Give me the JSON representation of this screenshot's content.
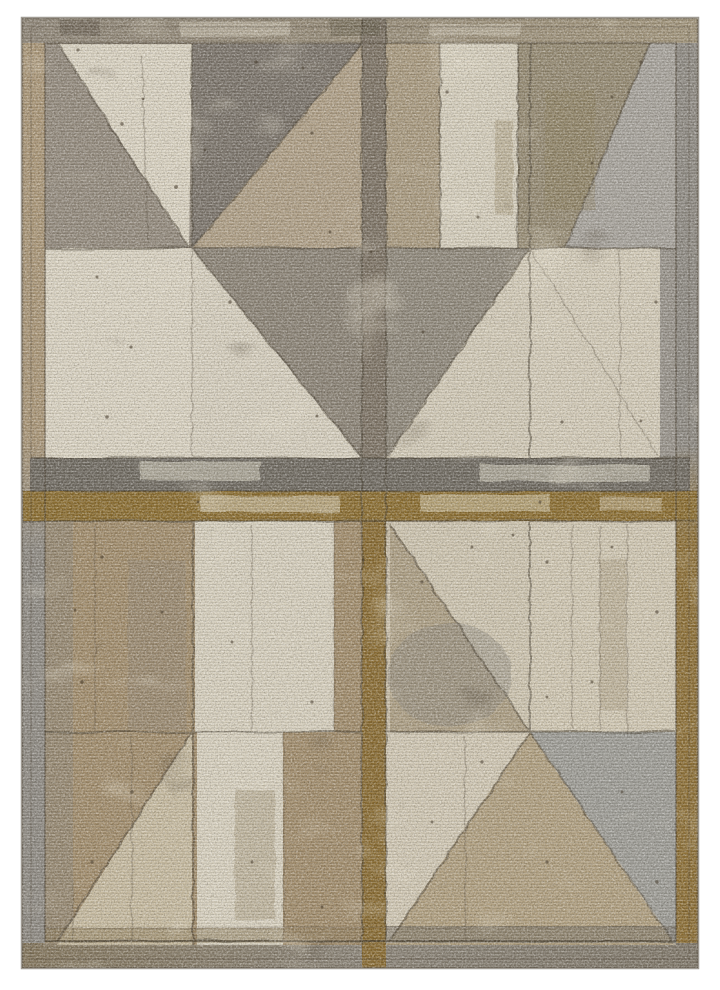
{
  "image": {
    "type": "product-photo",
    "subject": "Distressed geometric patchwork area rug with pinwheel barn-door panel design in gray, taupe, tan, cream and olive tones",
    "background": "#ffffff"
  },
  "colors": {
    "page_bg": "#ffffff",
    "outline": "#5f564a",
    "seam": "#4a3f30",
    "dot": "#44392a",
    "border_tan": "#ab9778",
    "border_gray": "#8f8b84",
    "border_olive": "#8d6f35",
    "border_top_a": "#8f8678",
    "border_top_b": "#a3967c",
    "border_bot_a": "#84765c",
    "border_bot_b": "#8b8478",
    "border_bot_c": "#7f7769",
    "vrail_top": "#7d7365",
    "vrail_bot": "#896b31",
    "rail_gray": "#6f6a61",
    "rail_olive": "#8b6d2f",
    "tl_base": "#948b7e",
    "tl_cream": "#dcd5c4",
    "tl_dark": "#7b746b",
    "tl_tan": "#b0a087",
    "tl_cream2": "#d8d1c0",
    "tl_gray_se": "#8b8376",
    "tr_base": "#a1967f",
    "tr_tan_strip": "#aa9b80",
    "tr_cream": "#d7d0be",
    "tr_dark": "#958a72",
    "tr_silver": "#a8a49d",
    "tr_gray_sw": "#8f887b",
    "tr_cream_sw": "#d3cbb8",
    "tr_cream_se": "#d5cdba",
    "tr_gray_edge": "#99948c",
    "bl_base": "#a28d6c",
    "bl_gray": "#8a847b",
    "bl_cream_up": "#d8d1bf",
    "bl_light": "#c8bca1",
    "bl_cream_low": "#d9d2c0",
    "bl_dark_strip": "#8a7856",
    "br_base": "#c9bea8",
    "br_light_ne": "#cfc6b1",
    "br_sw": "#ad9f84",
    "br_gray_stain": "#8c887f",
    "br_cream_ne": "#d2c9b4",
    "br_west": "#d2c9b5",
    "br_south": "#b1a080",
    "br_east": "#9e9d97",
    "br_dark_strip": "#6f695f",
    "stain_cream": "#e6dfcd",
    "stain_brown": "#8a7a52",
    "stain_dark": "#564c3c",
    "grain_light": "#ffffff",
    "grain_dark": "#262017"
  },
  "rug": {
    "nail_holes": [
      [
        78,
        50,
        1.6
      ],
      [
        256,
        62,
        1.8
      ],
      [
        303,
        68,
        1.5
      ],
      [
        122,
        124,
        1.7
      ],
      [
        143,
        99,
        1.4
      ],
      [
        176,
        187,
        1.9
      ],
      [
        312,
        133,
        1.6
      ],
      [
        330,
        232,
        1.5
      ],
      [
        97,
        277,
        1.5
      ],
      [
        230,
        302,
        1.7
      ],
      [
        131,
        347,
        1.6
      ],
      [
        107,
        417,
        1.8
      ],
      [
        317,
        416,
        1.5
      ],
      [
        371,
        252,
        1.5
      ],
      [
        363,
        560,
        1.5
      ],
      [
        447,
        92,
        1.6
      ],
      [
        478,
        217,
        1.5
      ],
      [
        612,
        97,
        1.5
      ],
      [
        641,
        62,
        1.7
      ],
      [
        592,
        163,
        1.4
      ],
      [
        656,
        302,
        1.6
      ],
      [
        423,
        332,
        1.5
      ],
      [
        562,
        422,
        1.6
      ],
      [
        641,
        421,
        1.4
      ],
      [
        540,
        502,
        1.5
      ],
      [
        102,
        557,
        1.6
      ],
      [
        162,
        612,
        1.5
      ],
      [
        82,
        682,
        1.8
      ],
      [
        232,
        642,
        1.5
      ],
      [
        312,
        702,
        1.6
      ],
      [
        132,
        792,
        1.7
      ],
      [
        92,
        862,
        1.6
      ],
      [
        252,
        862,
        1.5
      ],
      [
        322,
        907,
        1.5
      ],
      [
        198,
        502,
        1.4
      ],
      [
        422,
        582,
        1.6
      ],
      [
        472,
        547,
        1.5
      ],
      [
        513,
        535,
        1.4
      ],
      [
        547,
        562,
        1.6
      ],
      [
        612,
        547,
        1.4
      ],
      [
        657,
        612,
        1.7
      ],
      [
        592,
        682,
        1.5
      ],
      [
        547,
        697,
        1.4
      ],
      [
        482,
        762,
        1.6
      ],
      [
        432,
        822,
        1.5
      ],
      [
        547,
        862,
        1.6
      ],
      [
        622,
        792,
        1.5
      ],
      [
        657,
        882,
        1.7
      ],
      [
        205,
        150,
        1.4
      ],
      [
        75,
        610,
        1.4
      ]
    ]
  }
}
